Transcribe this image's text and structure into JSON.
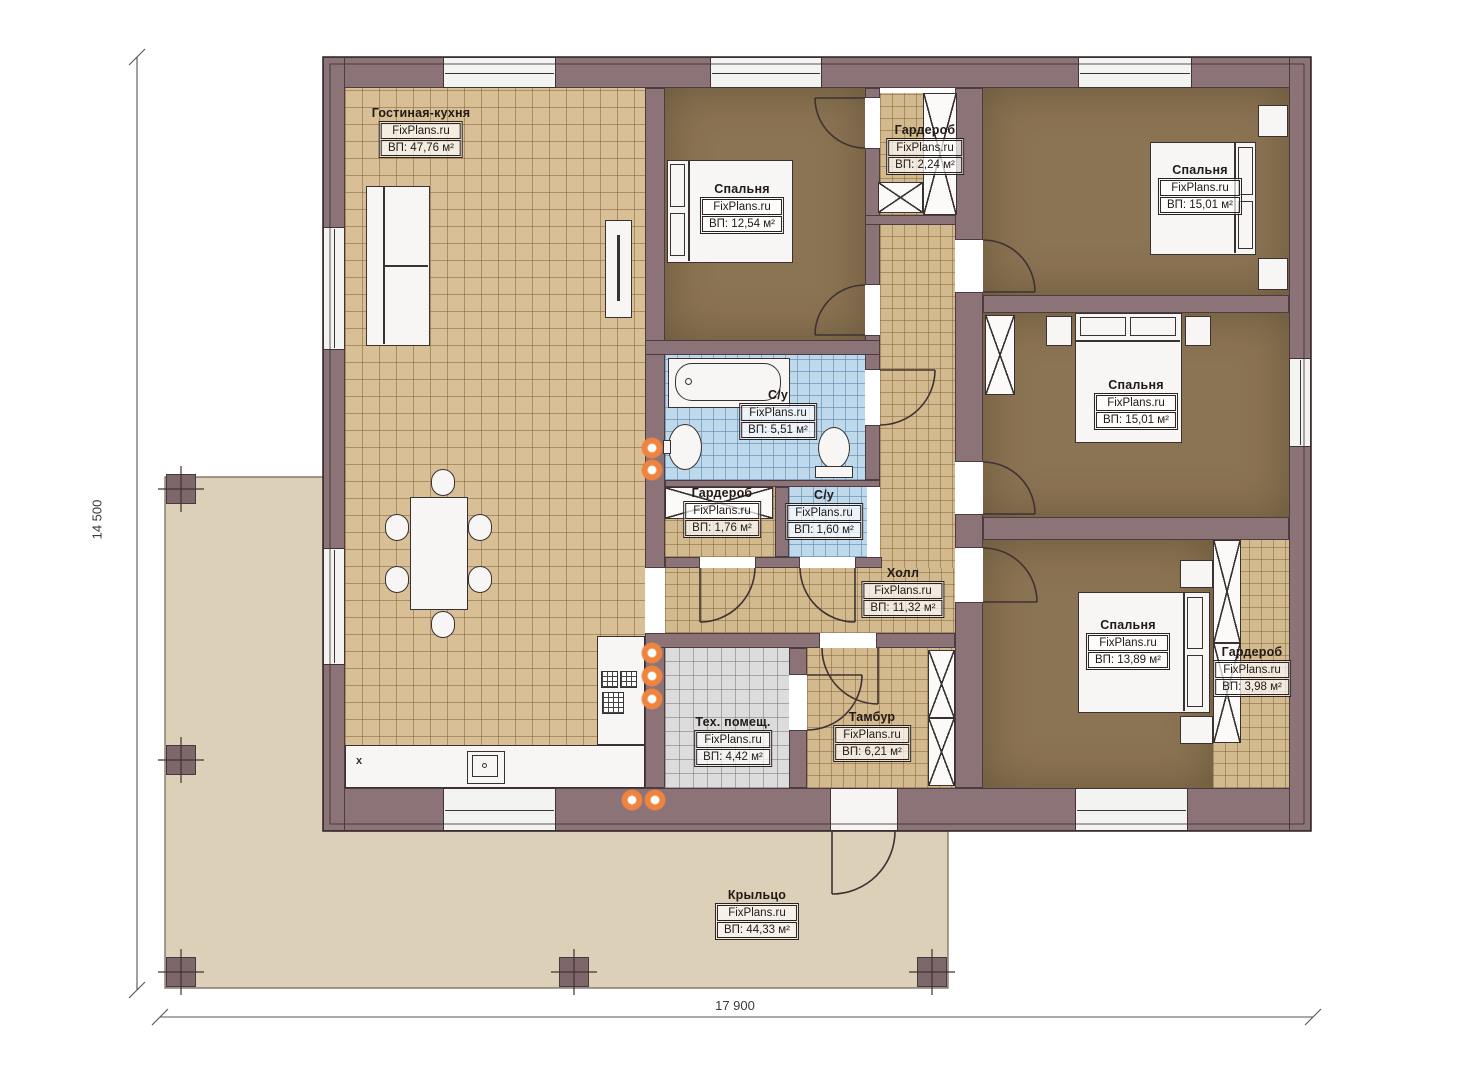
{
  "title": "План одноэтажного дома",
  "brand": "FixPlans.ru",
  "dimensions": {
    "height_label": "14 500",
    "width_label": "17 900"
  },
  "rooms": [
    {
      "name": "Гостиная-кухня",
      "brand": "FixPlans.ru",
      "area": "ВП: 47,76 м²"
    },
    {
      "name": "Спальня",
      "brand": "FixPlans.ru",
      "area": "ВП: 12,54 м²"
    },
    {
      "name": "Гардероб",
      "brand": "FixPlans.ru",
      "area": "ВП: 2,24 м²"
    },
    {
      "name": "Спальня",
      "brand": "FixPlans.ru",
      "area": "ВП: 15,01 м²"
    },
    {
      "name": "Спальня",
      "brand": "FixPlans.ru",
      "area": "ВП: 15,01 м²"
    },
    {
      "name": "С/у",
      "brand": "FixPlans.ru",
      "area": "ВП: 5,51 м²"
    },
    {
      "name": "Гардероб",
      "brand": "FixPlans.ru",
      "area": "ВП: 1,76 м²"
    },
    {
      "name": "С/у",
      "brand": "FixPlans.ru",
      "area": "ВП: 1,60 м²"
    },
    {
      "name": "Холл",
      "brand": "FixPlans.ru",
      "area": "ВП: 11,32 м²"
    },
    {
      "name": "Спальня",
      "brand": "FixPlans.ru",
      "area": "ВП: 13,89 м²"
    },
    {
      "name": "Гардероб",
      "brand": "FixPlans.ru",
      "area": "ВП: 3,98 м²"
    },
    {
      "name": "Тех. помещ.",
      "brand": "FixPlans.ru",
      "area": "ВП: 4,42 м²"
    },
    {
      "name": "Тамбур",
      "brand": "FixPlans.ru",
      "area": "ВП: 6,21 м²"
    },
    {
      "name": "Крыльцо",
      "brand": "FixPlans.ru",
      "area": "ВП: 44,33 м²"
    }
  ],
  "marks": {
    "kitchen_x": "x"
  },
  "colors": {
    "wall": "#8c7377",
    "wall_outline": "#4c3c40",
    "tile_living": "#d8bf95",
    "tile_hall": "#d3b98e",
    "tile_bath": "#bed8ec",
    "tile_tech": "#dcdcdc",
    "bedroom_floor": "#8b7453",
    "porch": "#ddd0b8",
    "accent_dot": "#ee8440"
  }
}
